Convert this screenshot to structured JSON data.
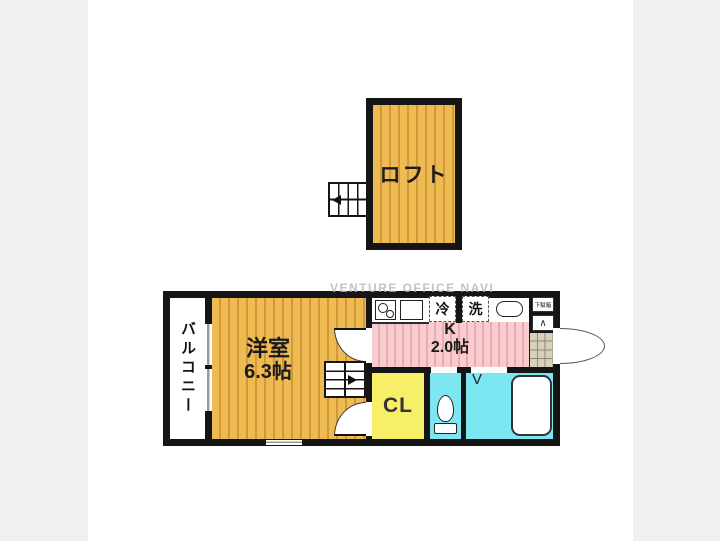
{
  "watermark": "VENTURE OFFICE NAVI",
  "loft": {
    "label": "ロフト"
  },
  "main_floor": {
    "balcony_label": "バルコニー",
    "room_label": "洋室",
    "room_size": "6.3帖",
    "kitchen_label": "K",
    "kitchen_size": "2.0帖",
    "closet_label": "CL",
    "fridge_label": "冷",
    "washer_label": "洗",
    "shoe_cabinet_label": "下駄箱",
    "bath_door_mark": "V",
    "entry_step_mark": "∧"
  },
  "colors": {
    "wall": "#151515",
    "wood_floor_base": "#eebb52",
    "wood_floor_stripe": "#d4983a",
    "kitchen_floor_base": "#f7cdd0",
    "kitchen_floor_stripe": "#e9abb1",
    "closet_fill": "#f6ef67",
    "wet_area_fill": "#7de7f1",
    "entry_tile": "#d9d1bc",
    "page_margin": "#f0f0f0",
    "watermark_text": "#b5b5b5"
  }
}
